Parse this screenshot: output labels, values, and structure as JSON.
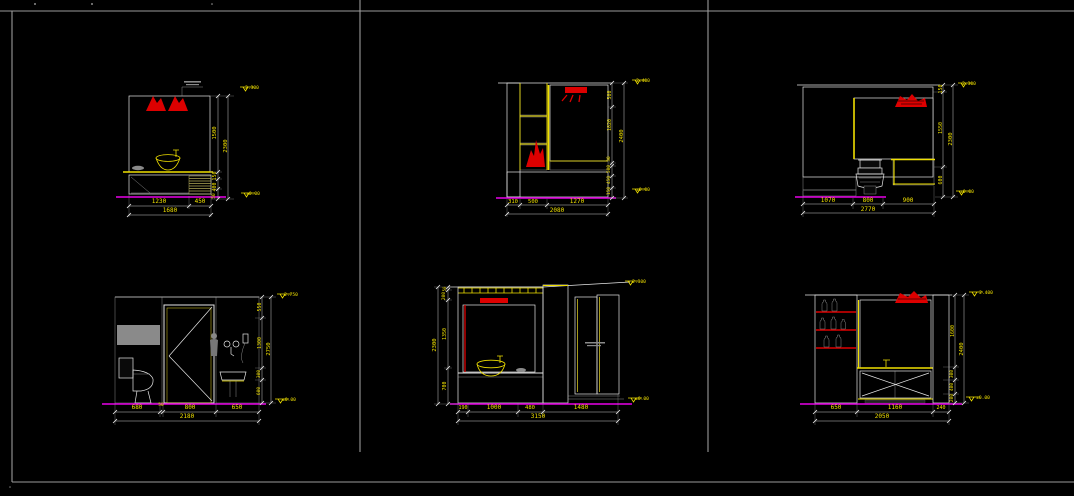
{
  "sheet": {
    "description": "bathroom interior elevation sheet, six CAD elevation views on black background",
    "units": "mm"
  },
  "colors": {
    "background": "#000000",
    "frame": "#9a9a9a",
    "line": "#e6e6e6",
    "dimension_text": "#f0e000",
    "accent_yellow": "#f0e000",
    "floor_line": "#e800e8",
    "accent_red": "#dd0000",
    "tile_gray": "#747474"
  },
  "panels": {
    "top_left": {
      "name": "vanity-mirror-elevation",
      "dims_bottom": [
        "1230",
        "450"
      ],
      "dims_bottom_total": "1680",
      "dims_right": [
        "1500",
        "150",
        "400",
        "50"
      ],
      "dims_right_total": "2300",
      "level_top": "2.300",
      "level_bottom": "±0.00"
    },
    "top_middle": {
      "name": "bathtub-mirror-elevation",
      "dims_bottom": [
        "310",
        "500",
        "1270"
      ],
      "dims_bottom_total": "2080",
      "dims_right": [
        "500",
        "1820",
        "30",
        "500",
        "450",
        "150"
      ],
      "dims_right_total": "2400",
      "level_top": "2.400",
      "level_bottom": "±0.00"
    },
    "top_right": {
      "name": "tiled-wall-toilet-elevation",
      "dims_bottom": [
        "1070",
        "800",
        "900"
      ],
      "dims_bottom_total": "2770",
      "dims_right": [
        "150",
        "1550",
        "600"
      ],
      "dims_right_total": "2300",
      "level_top": "2.300",
      "level_bottom": "±0.00"
    },
    "bottom_left": {
      "name": "toilet-door-shower-elevation",
      "dims_bottom": [
        "680",
        "50",
        "800",
        "650"
      ],
      "dims_bottom_total": "2180",
      "dims_right": [
        "550",
        "1300",
        "300",
        "600"
      ],
      "dims_right_total": "2750",
      "level_top": "2.750",
      "level_bottom": "±0.00"
    },
    "bottom_middle": {
      "name": "vanity-shower-glass-elevation",
      "dims_bottom": [
        "190",
        "1000",
        "480",
        "1480"
      ],
      "dims_bottom_total": "3150",
      "dims_left": [
        "50",
        "200",
        "1350",
        "700"
      ],
      "dims_left_total": "2300",
      "level_top": "2.300",
      "level_bottom": "±0.00"
    },
    "bottom_right": {
      "name": "shelving-vanity-elevation",
      "dims_bottom": [
        "650",
        "1160",
        "240"
      ],
      "dims_bottom_total": "2050",
      "dims_right": [
        "1600",
        "300",
        "400",
        "200"
      ],
      "dims_right_total": "2400",
      "level_top": "2.400",
      "level_bottom": "±0.00"
    }
  }
}
